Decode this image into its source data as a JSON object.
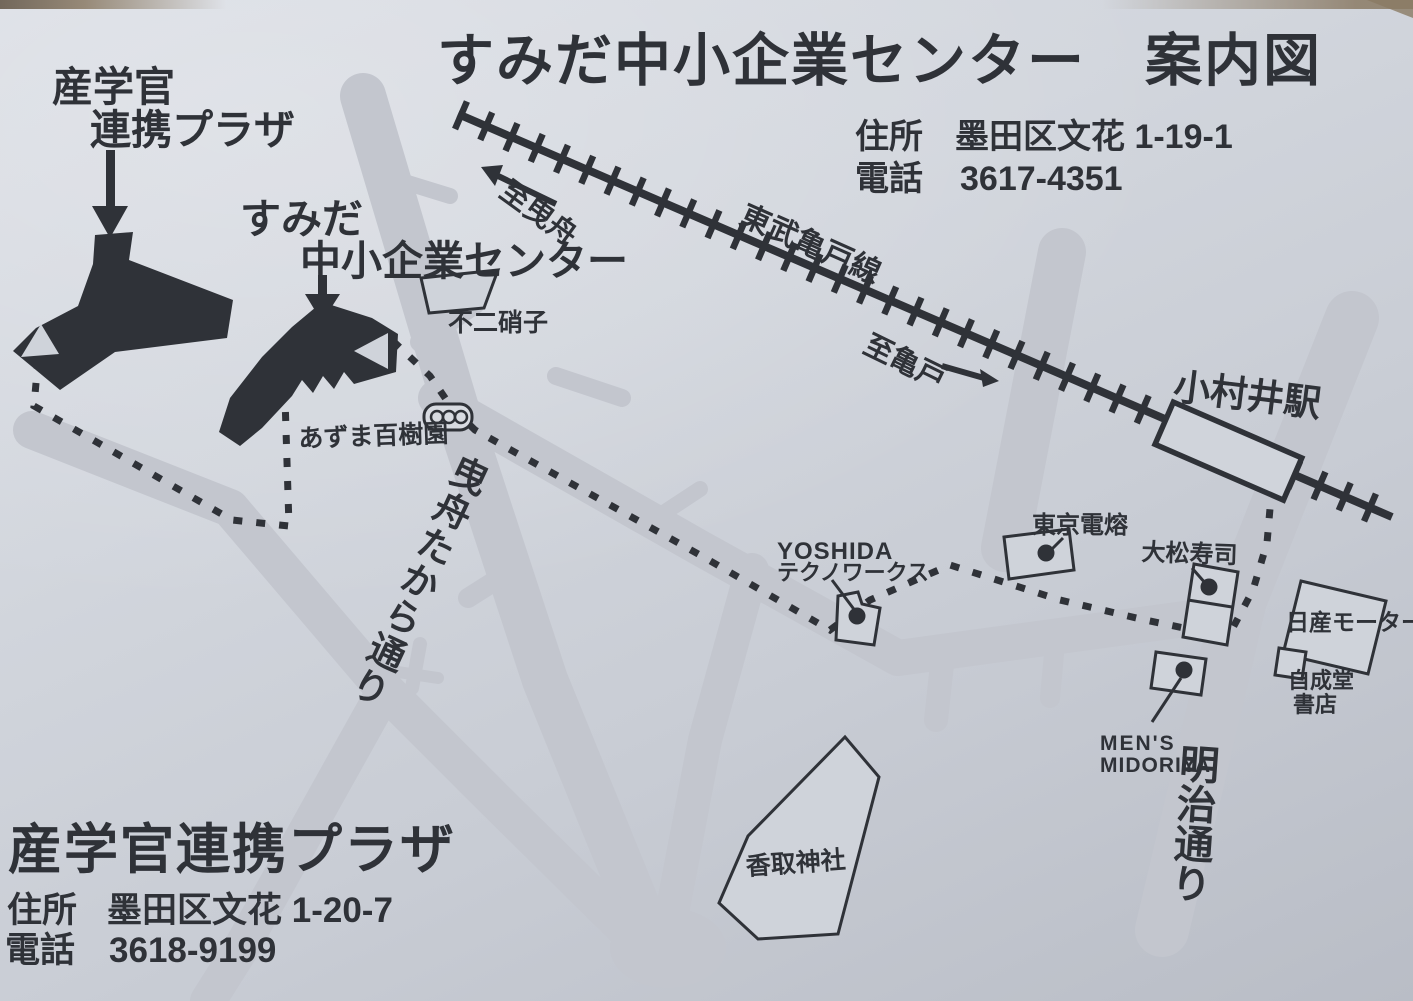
{
  "page": {
    "title": "すみだ中小企業センター　案内図"
  },
  "center": {
    "name_line1": "すみだ",
    "name_line2": "中小企業センター",
    "address_label": "住所",
    "address": "墨田区文花 1-19-1",
    "phone_label": "電話",
    "phone": "3617-4351"
  },
  "plaza": {
    "name_line1": "産学官",
    "name_line2": "連携プラザ",
    "name_full": "産学官連携プラザ",
    "address_label": "住所",
    "address": "墨田区文花 1-20-7",
    "phone_label": "電話",
    "phone": "3618-9199"
  },
  "railway": {
    "line_name": "東武亀戸線",
    "station": "小村井駅",
    "to_left": "至曳舟",
    "to_right": "至亀戸"
  },
  "streets": {
    "hikifune_takara_dori": "曳舟たから通り",
    "meiji_dori": "明治通り"
  },
  "landmarks": {
    "fuji_glass": "不二硝子",
    "azuma_hyakujuen": "あずま百樹園",
    "yoshida_line1": "YOSHIDA",
    "yoshida_line2": "テクノワークス",
    "tokyo_denyo": "東京電熔",
    "daimatsu_sushi": "大松寿司",
    "nissan_motor": "日産モーター",
    "jiseido_line1": "自成堂",
    "jiseido_line2": "書店",
    "mens_line1": "MEN'S",
    "mens_line2": "MIDORIYA",
    "katori_shrine": "香取神社"
  },
  "colors": {
    "ink": "#2f3238",
    "road": "#c3c6ce",
    "paper": "#cfd3da"
  }
}
